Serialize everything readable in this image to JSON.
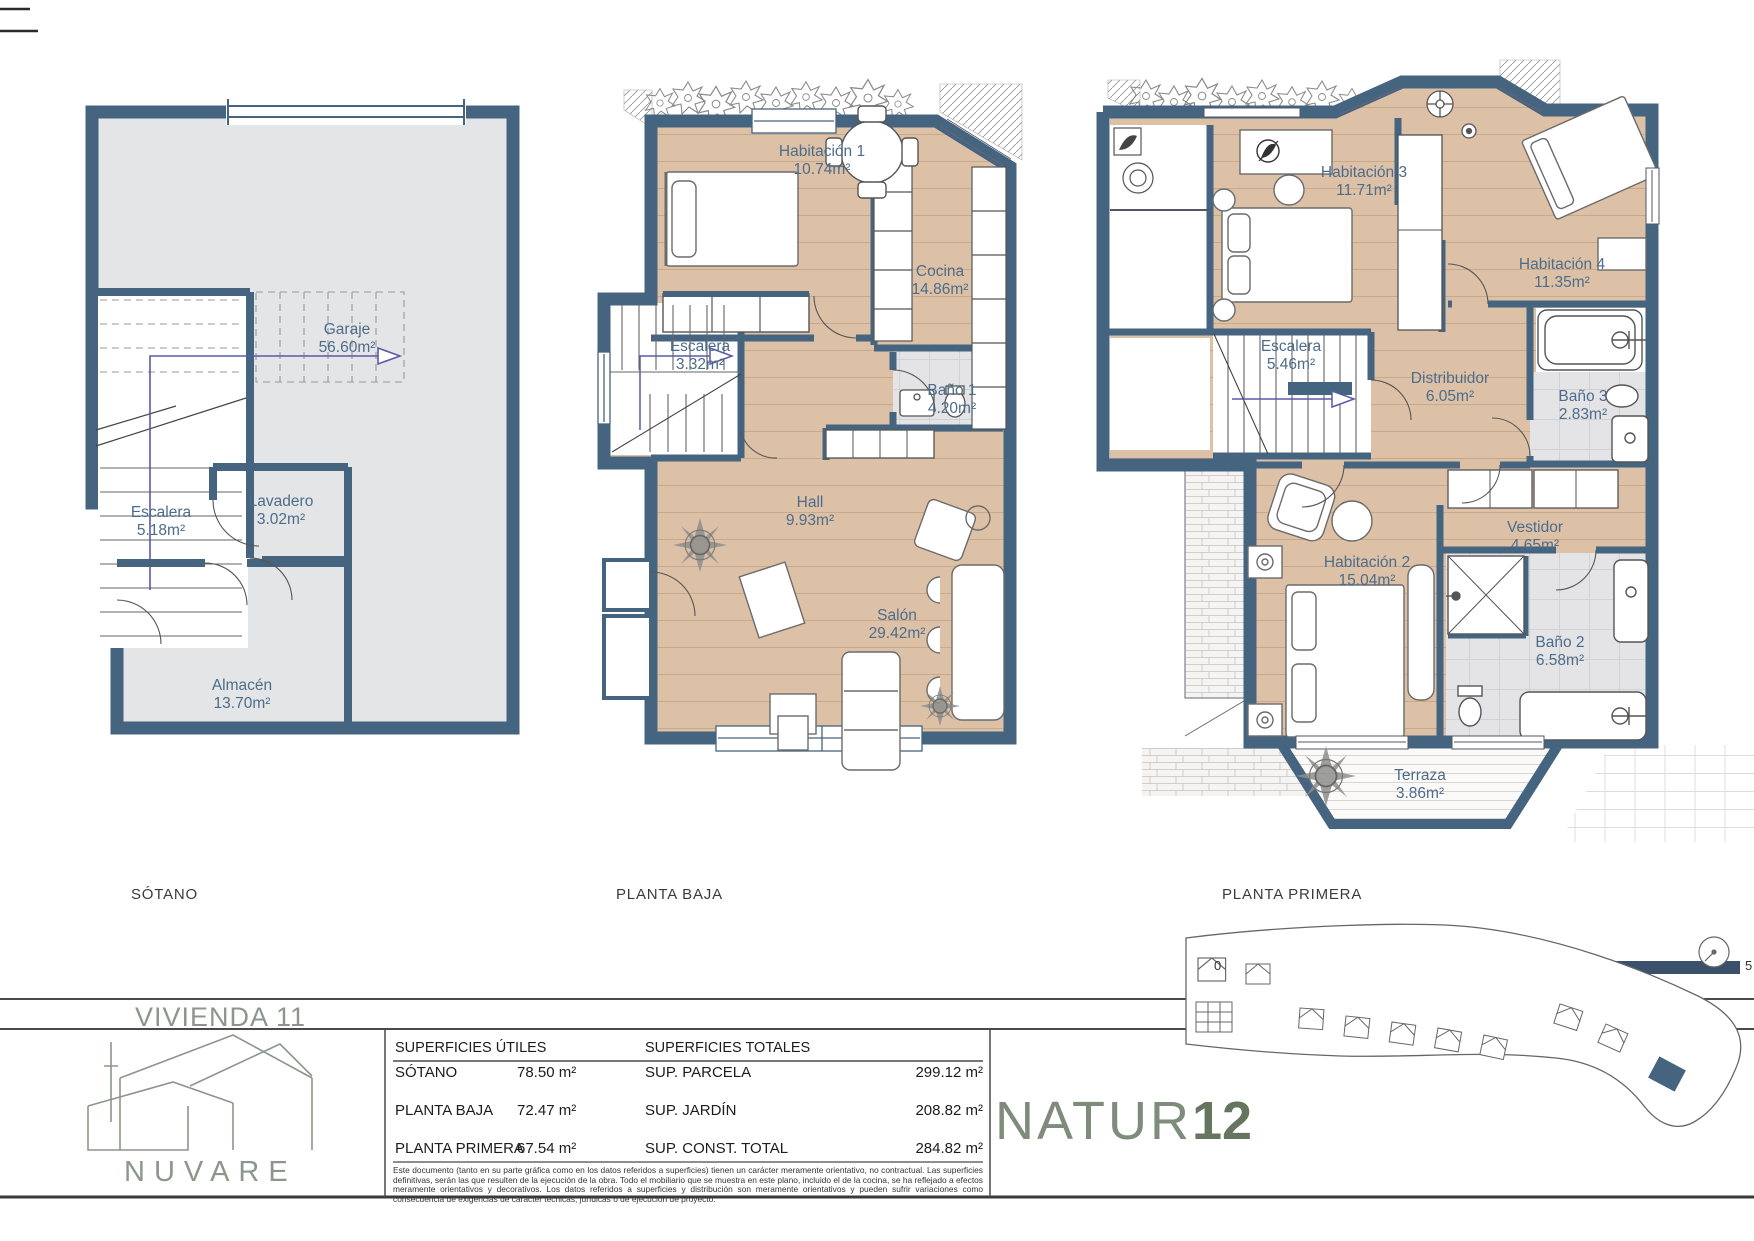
{
  "plans": [
    {
      "floor_label": "SÓTANO",
      "rooms": [
        {
          "name": "Garaje",
          "area": "56.60m²"
        },
        {
          "name": "Escalera",
          "area": "5.18m²"
        },
        {
          "name": "Lavadero",
          "area": "3.02m²"
        },
        {
          "name": "Almacén",
          "area": "13.70m²"
        }
      ]
    },
    {
      "floor_label": "PLANTA BAJA",
      "rooms": [
        {
          "name": "Habitación 1",
          "area": "10.74m²"
        },
        {
          "name": "Cocina",
          "area": "14.86m²"
        },
        {
          "name": "Escalera",
          "area": "3.32m²"
        },
        {
          "name": "Baño 1",
          "area": "4.20m²"
        },
        {
          "name": "Hall",
          "area": "9.93m²"
        },
        {
          "name": "Salón",
          "area": "29.42m²"
        }
      ]
    },
    {
      "floor_label": "PLANTA PRIMERA",
      "rooms": [
        {
          "name": "Habitación 3",
          "area": "11.71m²"
        },
        {
          "name": "Habitación 4",
          "area": "11.35m²"
        },
        {
          "name": "Escalera",
          "area": "5.46m²"
        },
        {
          "name": "Distribuidor",
          "area": "6.05m²"
        },
        {
          "name": "Baño 3",
          "area": "2.83m²"
        },
        {
          "name": "Vestidor",
          "area": "4.65m²"
        },
        {
          "name": "Habitación 2",
          "area": "15.04m²"
        },
        {
          "name": "Baño 2",
          "area": "6.58m²"
        },
        {
          "name": "Terraza",
          "area": "3.86m²"
        }
      ]
    }
  ],
  "title_block": {
    "title": "VIVIENDA 11"
  },
  "surfaces_table": {
    "col1_header": "SUPERFICIES ÚTILES",
    "col2_header": "SUPERFICIES TOTALES",
    "rows_utiles": [
      {
        "label": "SÓTANO",
        "value": "78.50 m²"
      },
      {
        "label": "PLANTA BAJA",
        "value": "72.47 m²"
      },
      {
        "label": "PLANTA PRIMERA",
        "value": "67.54 m²"
      }
    ],
    "rows_totales": [
      {
        "label": "SUP. PARCELA",
        "value": "299.12 m²"
      },
      {
        "label": "SUP. JARDÍN",
        "value": "208.82 m²"
      },
      {
        "label": "SUP. CONST. TOTAL",
        "value": "284.82 m²"
      }
    ],
    "disclaimer": "Este documento (tanto en su parte gráfica como en los datos referidos a superficies) tienen un carácter meramente orientativo, no contractual. Las superficies definitivas, serán las que resulten de la ejecución de la obra. Todo el mobiliario que se muestra en este plano, incluido el de la cocina, se ha reflejado a efectos meramente orientativos y decorativos. Los datos referidos a superficies y distribución son meramente orientativos y pueden sufrir variaciones como consecuencia de exigencias de carácter técnicas, jurídicas o de ejecución de proyecto."
  },
  "branding": {
    "developer_logo_text": "NUVARE",
    "project_logo_text": "NATUR",
    "project_logo_number": "12"
  },
  "scale_bar": {
    "min_label": "0",
    "max_label": "5"
  },
  "colors": {
    "wall": "#456480",
    "wood_floor": "#ddc1a6",
    "tile_floor": "#e4e4e6",
    "label_text": "#4d6c8c",
    "brand_green": "#8c968c"
  }
}
